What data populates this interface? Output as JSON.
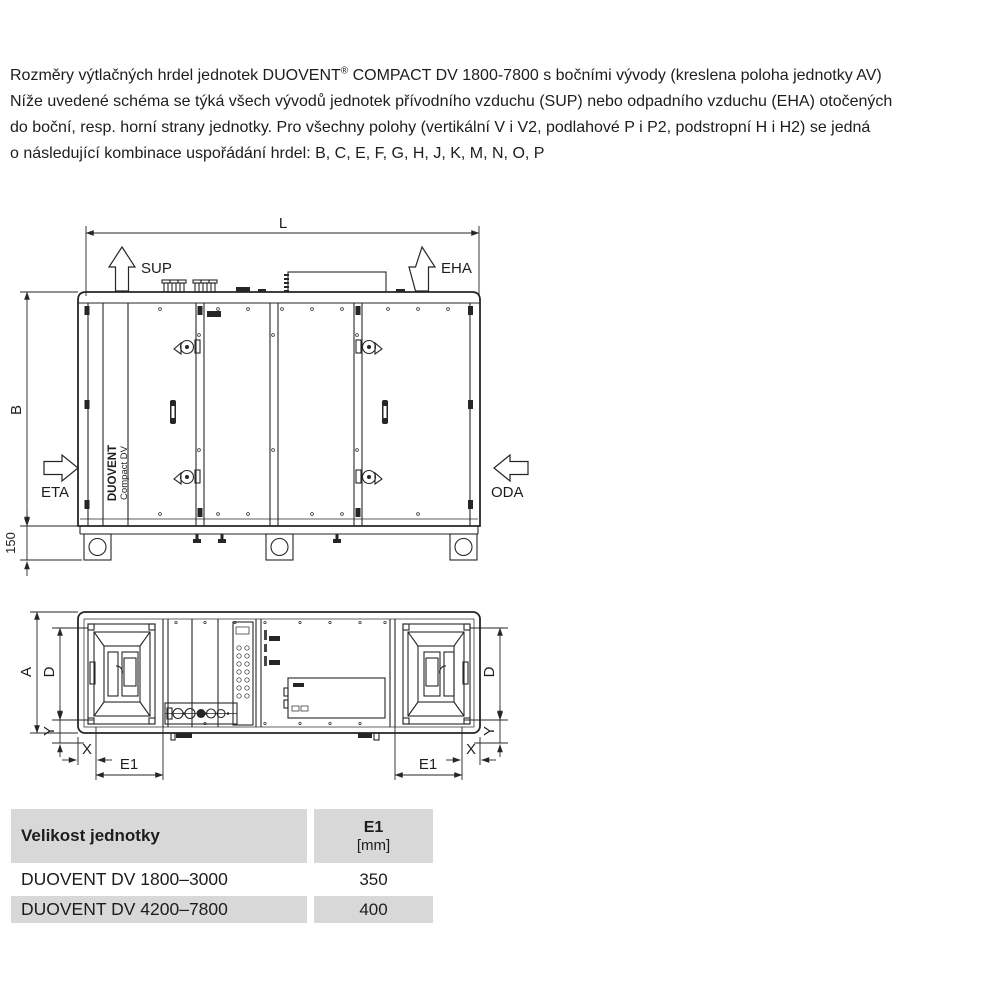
{
  "intro": {
    "line1_pre": "Rozměry výtlačných hrdel jednotek DUOVENT",
    "line1_sup": "®",
    "line1_post": " COMPACT DV 1800-7800 s bočními vývody (kreslena poloha jednotky AV)",
    "line2": "Níže uvedené schéma se týká všech vývodů jednotek přívodního vzduchu (SUP) nebo odpadního vzduchu (EHA) otočených",
    "line3": "do boční, resp. horní strany jednotky. Pro všechny polohy (vertikální V i V2, podlahové P i P2, podstropní H i H2) se jedná",
    "line4": "o následující kombinace uspořádání hrdel: B, C, E, F, G, H, J, K, M, N, O, P"
  },
  "side_view": {
    "dim_length": "L",
    "dim_height": "B",
    "dim_base_height": "150",
    "supply_label": "SUP",
    "exhaust_label": "EHA",
    "extract_label": "ETA",
    "outdoor_label": "ODA",
    "brand_name": "DUOVENT",
    "brand_model": "Compact DV"
  },
  "top_view": {
    "dim_width": "A",
    "dim_fan_width": "D",
    "dim_y": "Y",
    "dim_x": "X",
    "dim_e1": "E1"
  },
  "table": {
    "header_col1": "Velikost jednotky",
    "header_col2_line1": "E1",
    "header_col2_line2": "[mm]",
    "rows": [
      {
        "label": "DUOVENT DV 1800–3000",
        "e1": "350"
      },
      {
        "label": "DUOVENT DV 4200–7800",
        "e1": "400"
      }
    ]
  },
  "colors": {
    "line": "#262626",
    "text": "#1d1d1b",
    "table_header_bg": "#d8d8d8",
    "page_bg": "#ffffff"
  }
}
